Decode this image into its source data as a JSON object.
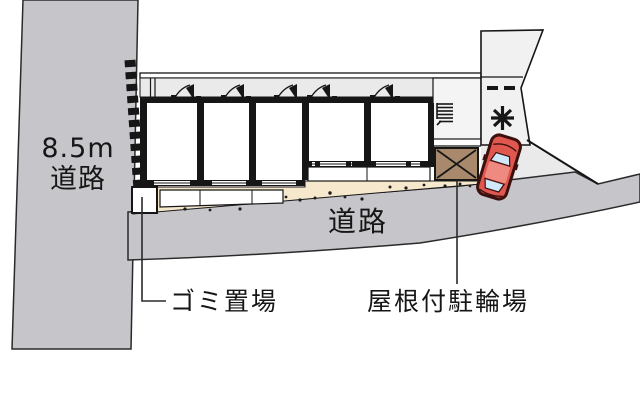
{
  "page": {
    "background": "#ffffff",
    "type": "site-plan-diagram"
  },
  "roads": {
    "left": {
      "label_line1": "8.5m",
      "label_line2": "道路",
      "color": "#c6c6ca"
    },
    "bottom": {
      "label": "道路",
      "color": "#c6c6ca"
    }
  },
  "site": {
    "surface_color": "#eaeaea",
    "parking_area_color": "#f1f1f1",
    "ground_strip_color": "#f5e8cd",
    "wall_color": "#161616",
    "garbage": {
      "label": "ゴミ置場"
    },
    "bike_shed": {
      "label": "屋根付駐輪場",
      "color": "#a8896c"
    },
    "parking_marks": {
      "dashes": "--",
      "star": "*"
    }
  },
  "car": {
    "body_color": "#df574e",
    "roof_color": "#ee8a80",
    "window_color": "#cfe9fb",
    "outline_color": "#3c100d"
  }
}
